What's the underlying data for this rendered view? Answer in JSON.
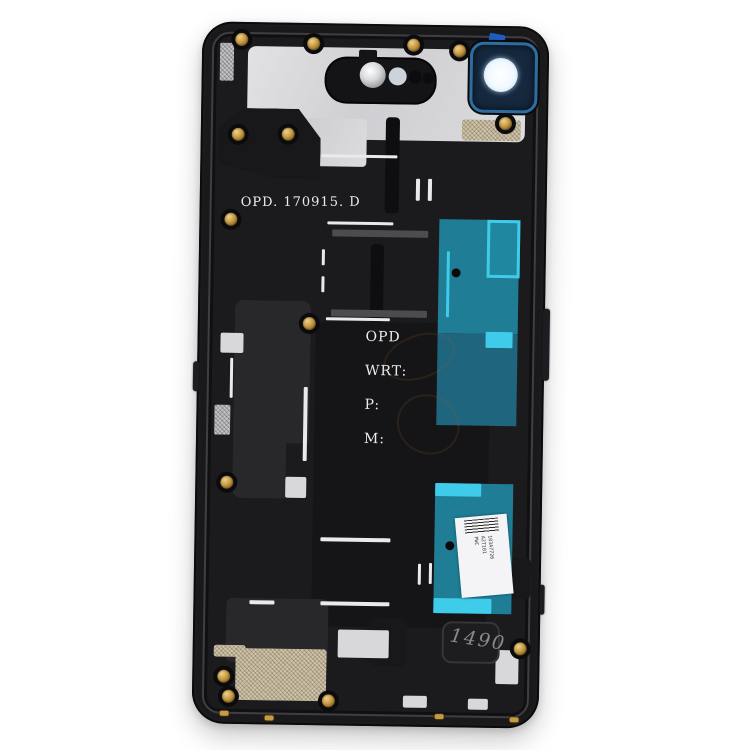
{
  "photo": {
    "subject": "Smartphone rear housing mid-frame, inside view, on white background",
    "background": "#ffffff"
  },
  "markings": {
    "date_code": "OPD. 170915. D",
    "spec_label_1": "OPD",
    "spec_label_2": "WRT:",
    "spec_label_3": "P:",
    "spec_label_4": "M:",
    "handwritten_code": "1490",
    "sticker_line_1": "103A7726",
    "sticker_line_2": "A2T101",
    "sticker_line_3": "PWC"
  },
  "colors": {
    "frame_black": "#19191b",
    "cavity_black": "#1b1b1e",
    "plate_silver": "#d6d6d8",
    "adhesive_teal": "#1f7e96",
    "adhesive_cyan": "#3fcbea",
    "lens_navy": "#15283d",
    "gasket_blue": "#2e6da0",
    "screw_gold": "#c79b44",
    "mesh_tan": "#cec4aa",
    "paint_white": "#eaeaec"
  }
}
